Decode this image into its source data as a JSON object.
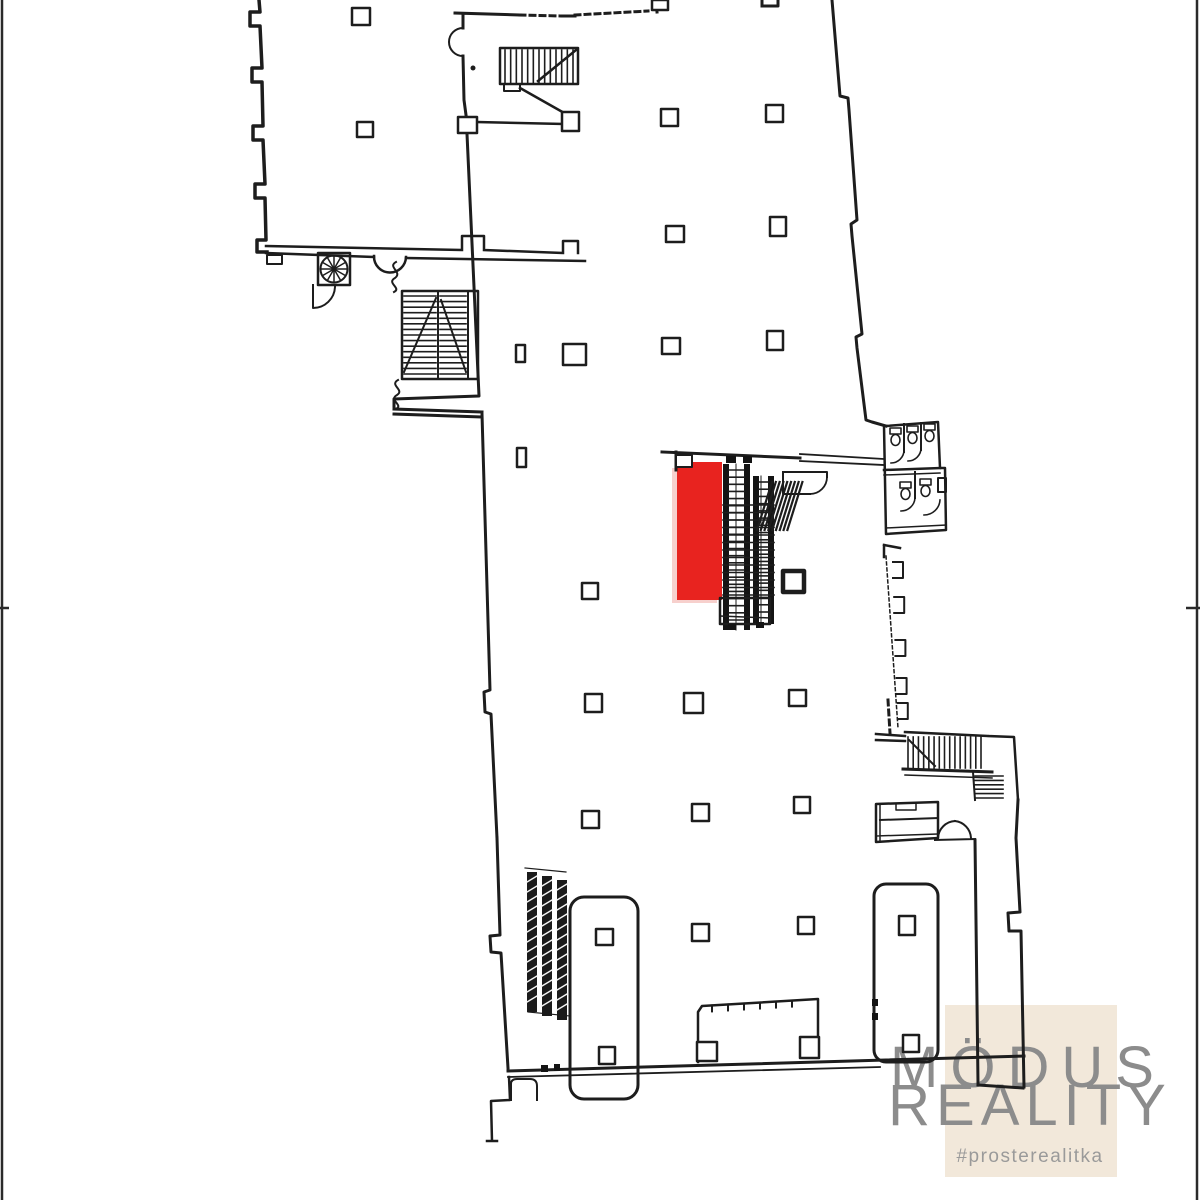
{
  "watermark": {
    "brand_top": "MÖDUS",
    "brand_bottom": "REALITY",
    "hashtag": "#prosterealitka",
    "panel_color": "#f2e8da",
    "brand_color": "#8c8c8c",
    "hashtag_color": "#9a9a9a"
  },
  "plan": {
    "highlight_color": "#e8231f",
    "highlight_shadow_color": "#f0a9a4",
    "line_color": "#1d1d1d",
    "background_color": "#ffffff"
  }
}
